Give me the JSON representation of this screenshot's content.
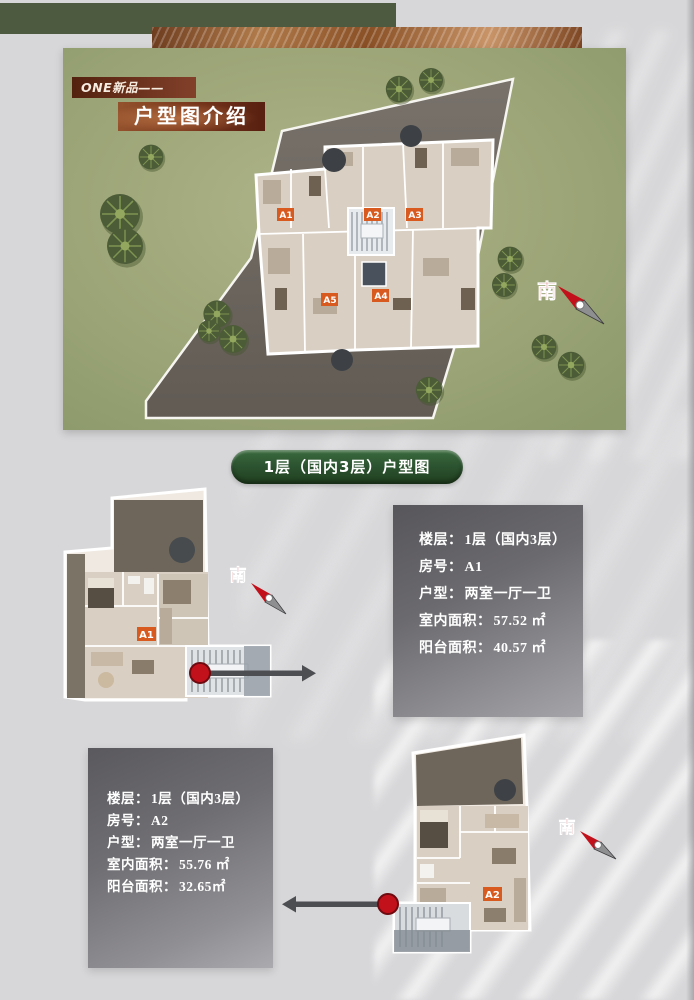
{
  "page": {
    "background": "#d7d7d9"
  },
  "header": {
    "eyebrow": "ONE新品——",
    "title": "户型图介绍",
    "green_bar_color": "#4e5a40",
    "copper_color": "#8a5026"
  },
  "site_plan": {
    "compass": "南",
    "unit_labels": [
      "A1",
      "A2",
      "A3",
      "A5",
      "A4"
    ],
    "grass_color": "#9ca577",
    "pavement_color": "#6c665f",
    "unit_tag_color": "#d85a1e",
    "compass_red": "#b5121b"
  },
  "section_badge": {
    "label": "1层（国内3层）户型图",
    "color": "#2c5430"
  },
  "units": [
    {
      "tag": "A1",
      "compass": "南",
      "info": {
        "floor_label": "楼层：",
        "floor_value": "1层（国内3层）",
        "room_label": "房号：",
        "room_value": "A1",
        "type_label": "户型：",
        "type_value": "两室一厅一卫",
        "area_label": "室内面积：",
        "area_value": "57.52 ㎡",
        "balcony_label": "阳台面积：",
        "balcony_value": "40.57 ㎡"
      }
    },
    {
      "tag": "A2",
      "compass": "南",
      "info": {
        "floor_label": "楼层：",
        "floor_value": "1层（国内3层）",
        "room_label": "房号：",
        "room_value": "A2",
        "type_label": "户型：",
        "type_value": "两室一厅一卫",
        "area_label": "室内面积：",
        "area_value": "55.76 ㎡",
        "balcony_label": "阳台面积：",
        "balcony_value": "32.65㎡"
      }
    }
  ]
}
